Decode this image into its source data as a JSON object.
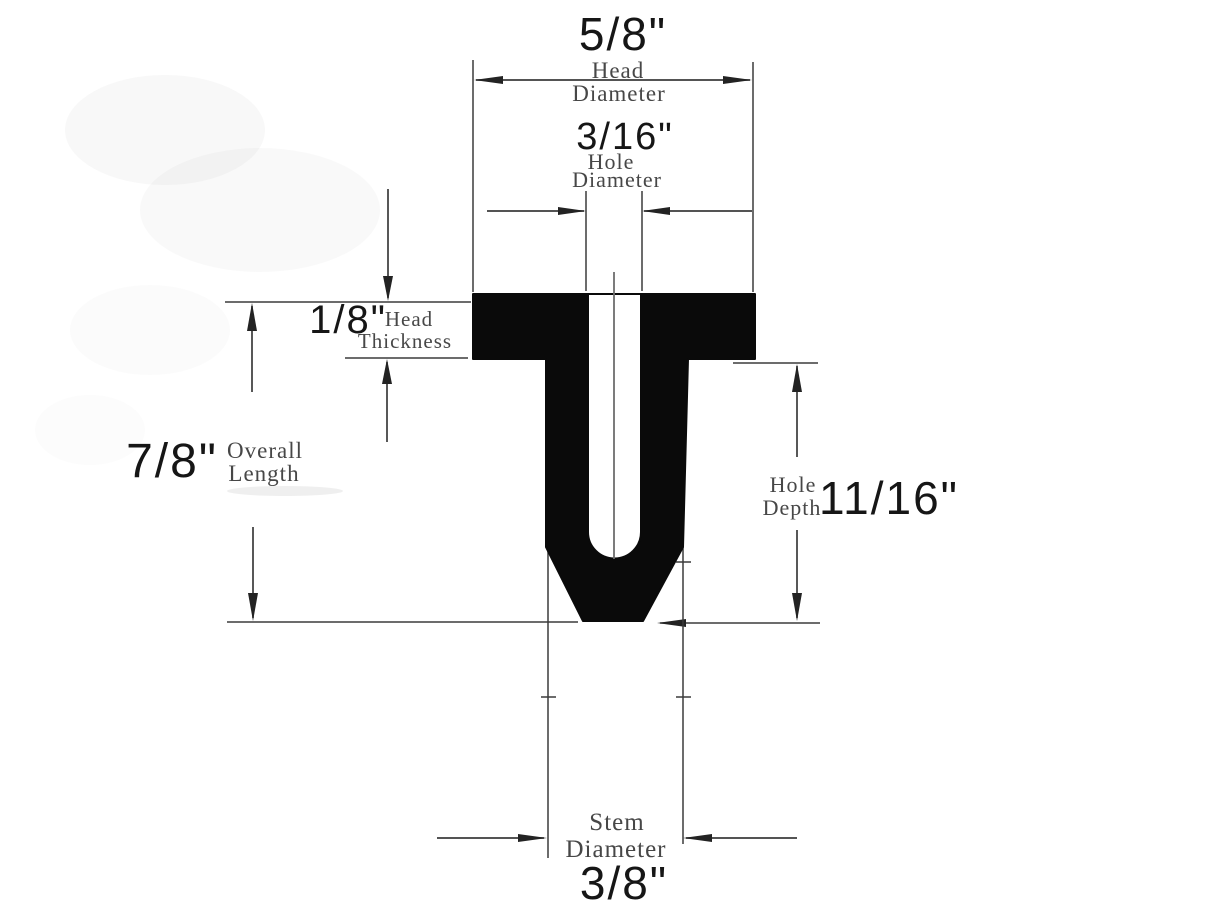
{
  "diagram": {
    "head_diameter": {
      "value": "5/8\"",
      "label": [
        "Head",
        "Diameter"
      ]
    },
    "hole_diameter": {
      "value": "3/16\"",
      "label": [
        "Hole",
        "Diameter"
      ]
    },
    "head_thickness": {
      "value": "1/8\"",
      "label": [
        "Head",
        "Thickness"
      ]
    },
    "overall_length": {
      "value": "7/8\"",
      "label": [
        "Overall",
        "Length"
      ]
    },
    "hole_depth": {
      "value": "11/16\"",
      "label": [
        "Hole",
        "Depth"
      ]
    },
    "stem_diameter": {
      "value": "3/8\"",
      "label": [
        "Stem",
        "Diameter"
      ]
    }
  },
  "colors": {
    "background": "#ffffff",
    "body_fill": "#0a0a0a",
    "line": "#3b3b3b",
    "label_text": "#474747",
    "value_text": "#161616",
    "centerline": "#6e6e6e"
  }
}
